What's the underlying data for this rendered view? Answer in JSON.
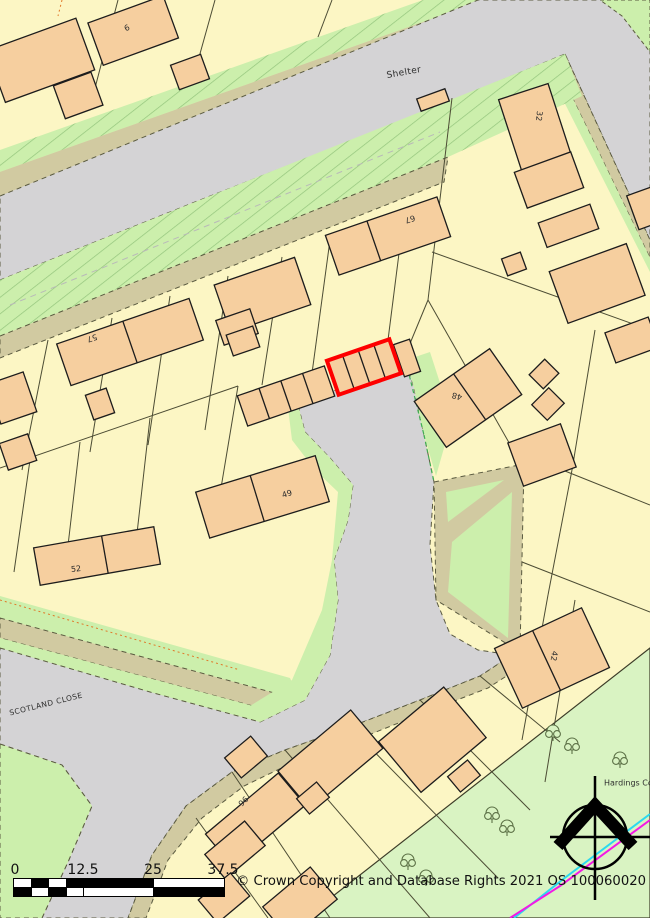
{
  "map": {
    "title": "Ordnance Survey site location plan",
    "street_labels": {
      "shelter": "Shelter",
      "scotland_close": "SCOTLAND CLOSE",
      "hardings_copse": "Hardings Cop"
    },
    "house_numbers": {
      "n6": "6",
      "n57": "57",
      "n67": "67",
      "n48": "48",
      "n49": "49",
      "n52": "52",
      "n42": "42",
      "n96": "96",
      "n32": "32"
    },
    "colors": {
      "parcel_yellow": "#FCF6C4",
      "building_peach": "#F6CF9F",
      "road_gray": "#D4D3D5",
      "verge_tan": "#D1CAA1",
      "green": "#CCEFAC",
      "woodland_green": "#D9F3C2",
      "plot_outline": "#FE0000",
      "path_magenta": "#F31AE5",
      "path_cyan": "#2BD9EF"
    }
  },
  "scalebar": {
    "t0": "0",
    "t1": "12.5",
    "t2": "25",
    "t3": "37.5"
  },
  "footer": {
    "copyright": "© Crown Copyright and Database Rights 2021 OS 100060020"
  }
}
